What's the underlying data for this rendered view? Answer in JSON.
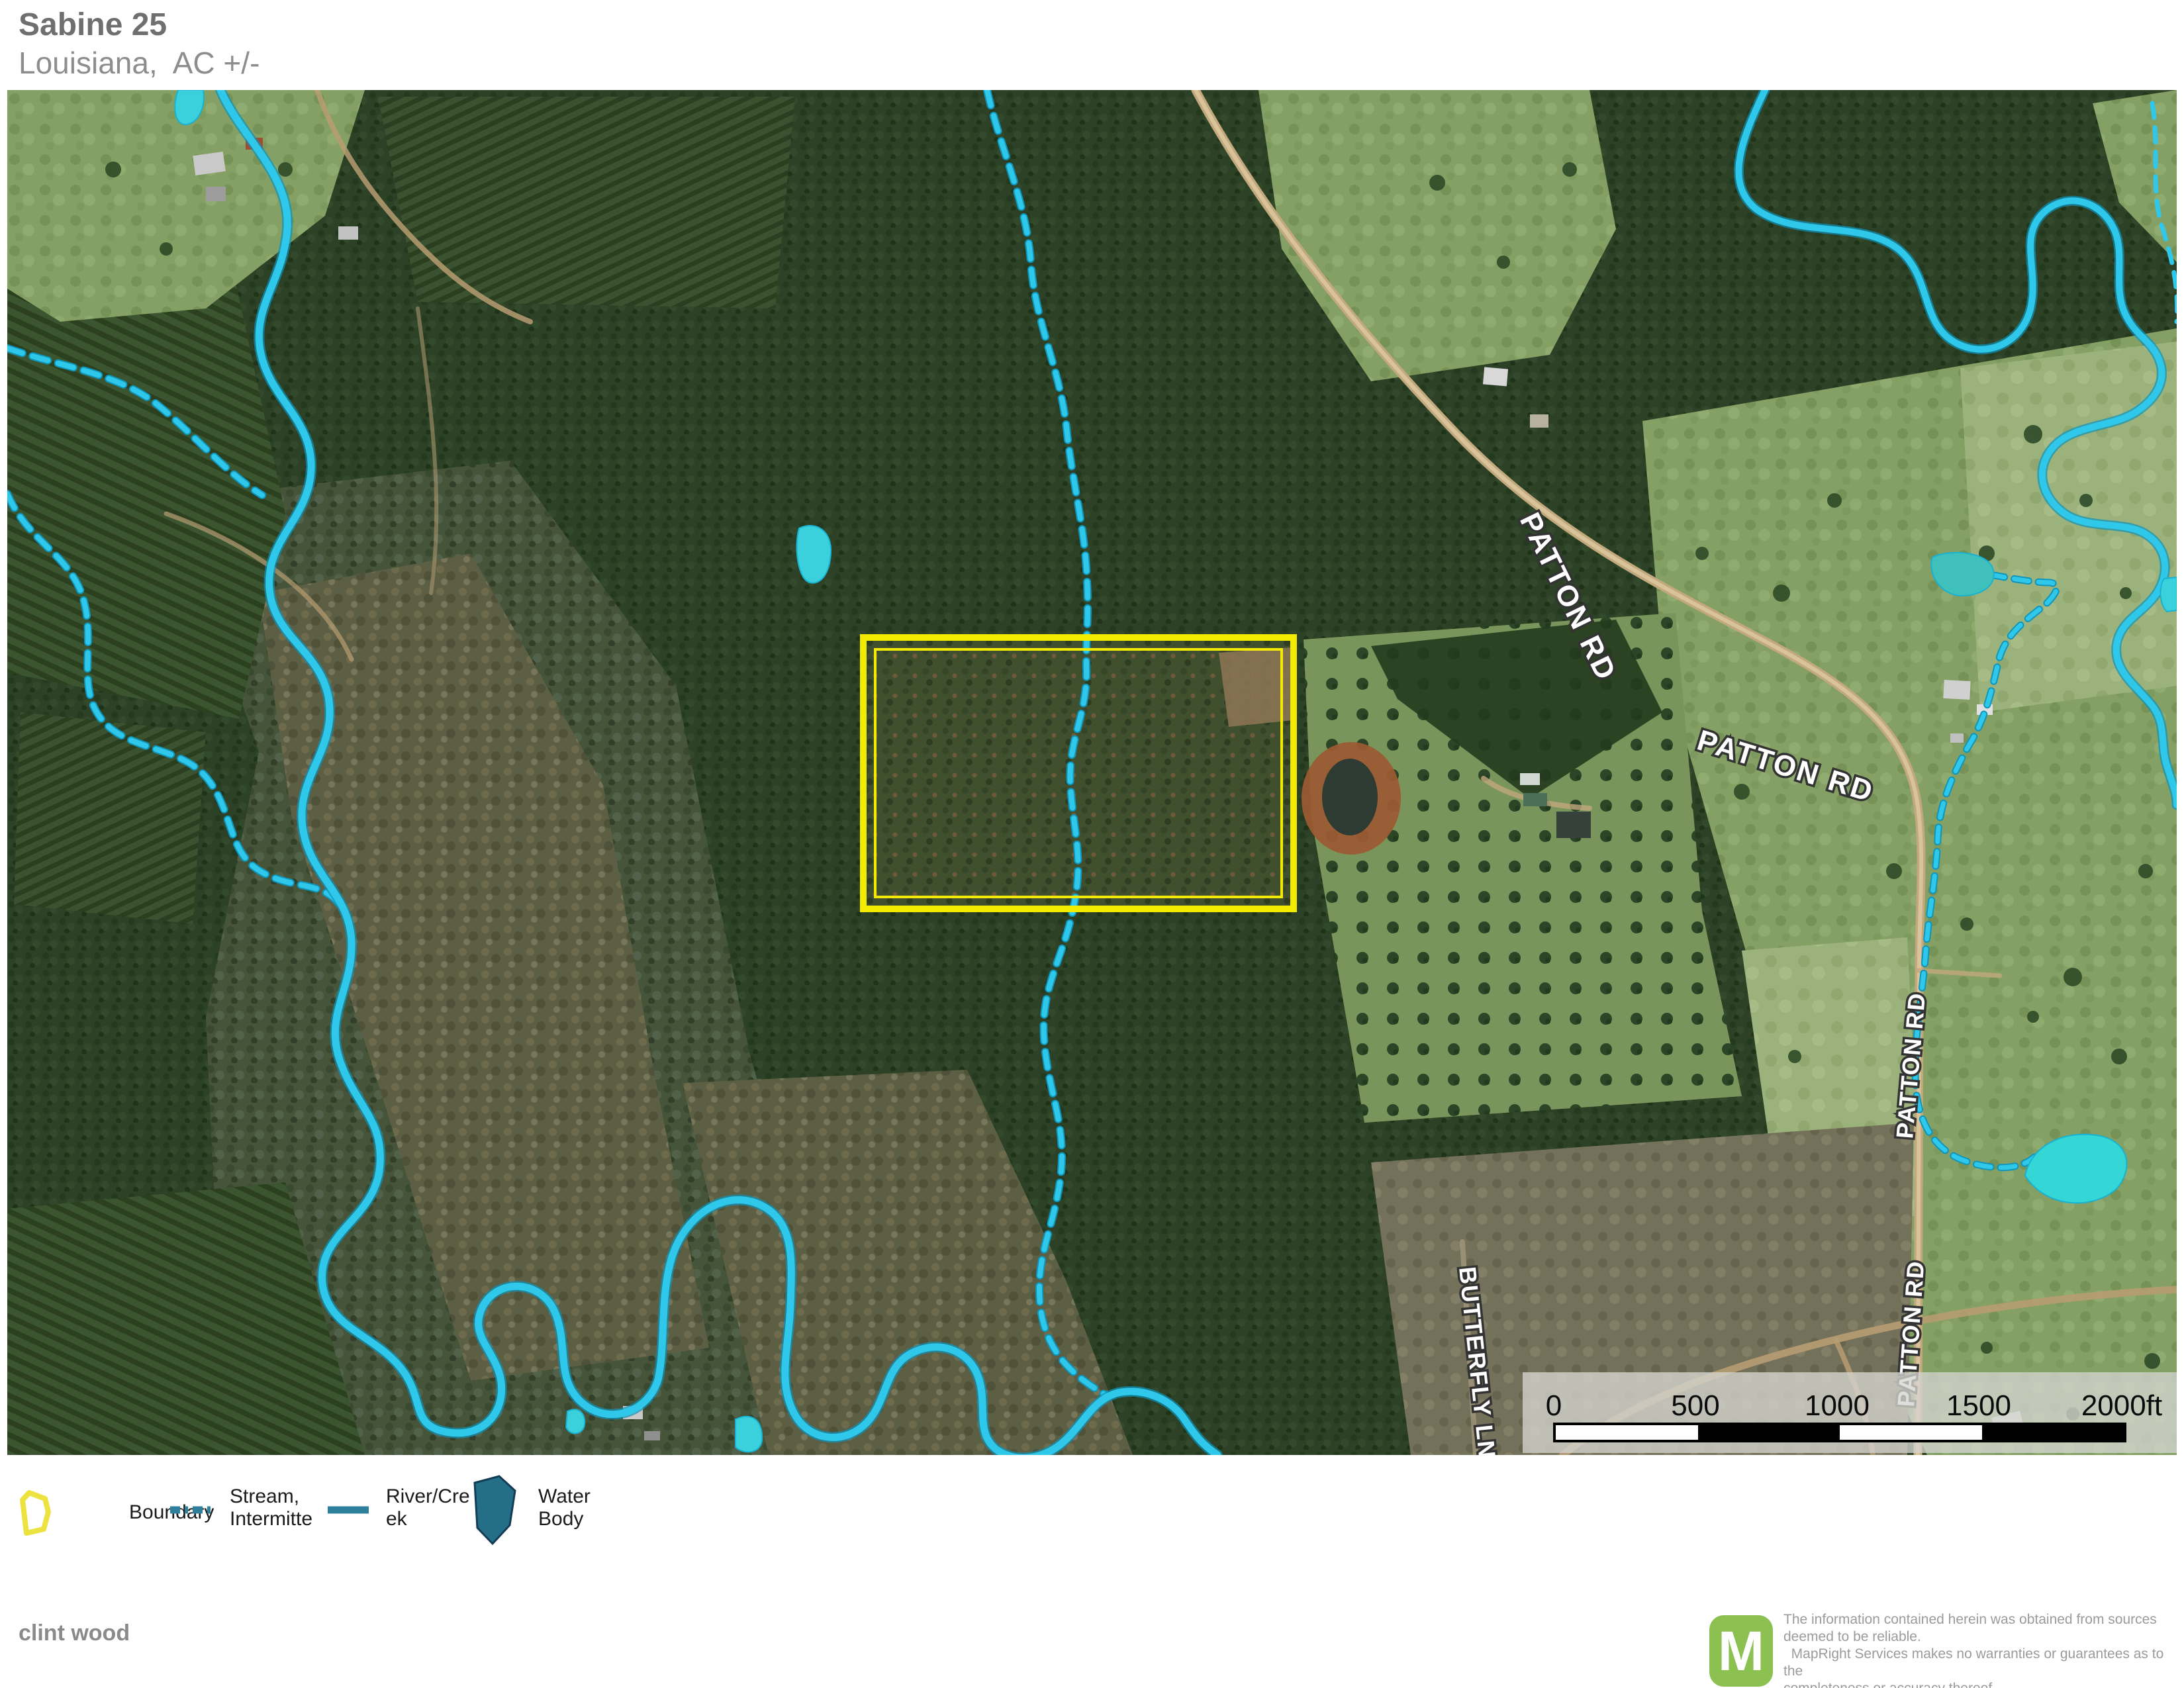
{
  "header": {
    "title": "Sabine 25",
    "subtitle": "Louisiana,  AC +/-"
  },
  "map": {
    "road_labels": [
      {
        "text": "PATTON RD"
      },
      {
        "text": "PATTON RD"
      },
      {
        "text": "PATTON RD"
      },
      {
        "text": "PATTON RD"
      },
      {
        "text": "BUTTERFLY LN"
      }
    ],
    "scale_bar": {
      "ticks": [
        "0",
        "500",
        "1000",
        "1500",
        "2000ft"
      ]
    }
  },
  "legend": {
    "items": [
      {
        "key": "boundary",
        "lines": [
          "Boundary"
        ]
      },
      {
        "key": "stream-intermittent",
        "lines": [
          "Stream,",
          "Intermitte"
        ]
      },
      {
        "key": "river-creek",
        "lines": [
          "River/Cre",
          "ek"
        ]
      },
      {
        "key": "water-body",
        "lines": [
          "Water",
          "Body"
        ]
      }
    ]
  },
  "footer": {
    "prepared_by": "clint wood",
    "logo_letter": "M",
    "disclaimer_lines": [
      "The information contained herein was obtained from sources",
      "deemed to be reliable.",
      "  MapRight Services makes no warranties or guarantees as to the",
      "completeness or accuracy thereof."
    ]
  },
  "colors": {
    "boundary_yellow": "#f2ea00",
    "stream_cyan": "#2fc8ea",
    "legend_line_teal": "#2e7f9c",
    "legend_water_fill": "#256e88",
    "logo_green": "#8cc152"
  }
}
